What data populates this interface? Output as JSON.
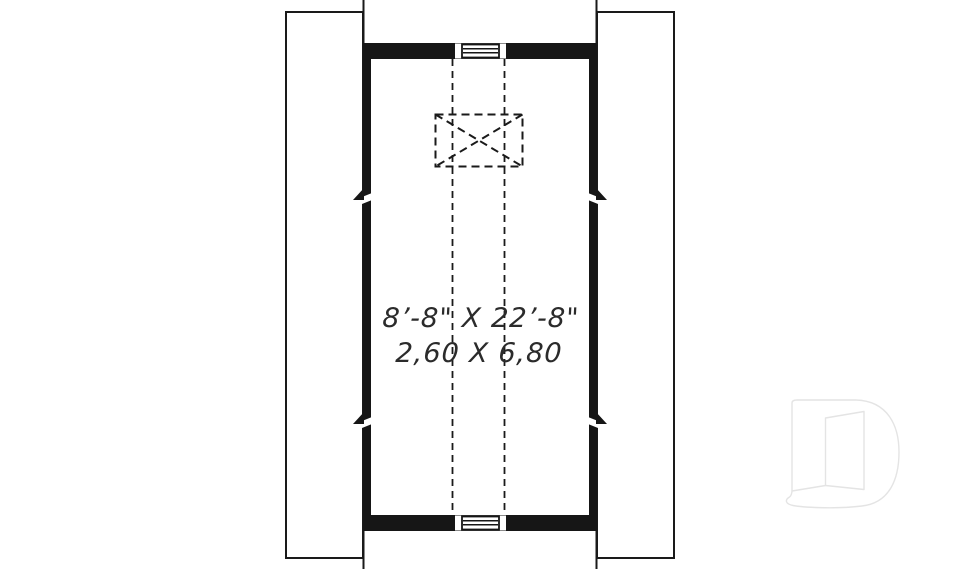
{
  "colors": {
    "bg": "#ffffff",
    "wall": "#161616",
    "line": "#1a1a1a",
    "text": "#2b2b2b",
    "watermark": "#e4e4e4"
  },
  "plan": {
    "dimension_imperial": "8’-8\" X 22’-8\"",
    "dimension_metric": "2,60 X 6,80"
  },
  "icons": {
    "watermark": "drummond-d-door-logo",
    "vent": "louvered-gable-vent",
    "chase": "dashed-x-chase-box"
  }
}
